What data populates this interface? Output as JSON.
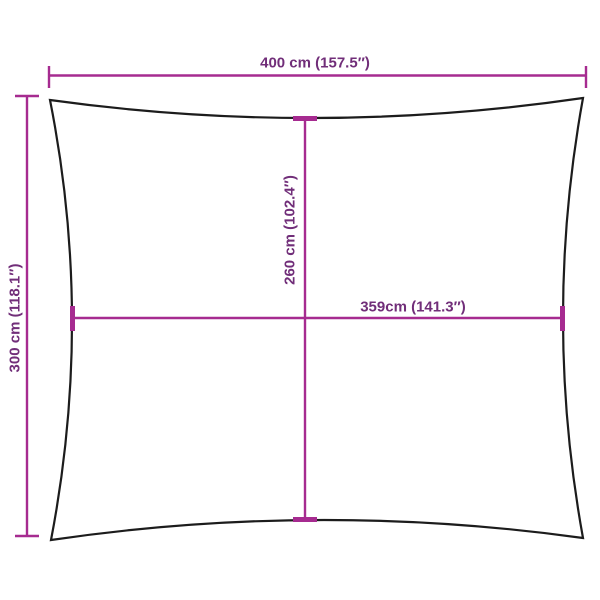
{
  "diagram": {
    "type": "product-dimension-diagram",
    "subject": "rectangular-shade-sail-outline",
    "labels": {
      "top_width": "400 cm (157.5″)",
      "left_height": "300 cm (118.1″)",
      "center_height": "260 cm (102.4″)",
      "center_width": "359cm (141.3″)"
    },
    "colors": {
      "dimension_line": "#A62B90",
      "dimension_text": "#712E79",
      "outline": "#1C1C1C",
      "background": "#FFFFFF"
    }
  }
}
